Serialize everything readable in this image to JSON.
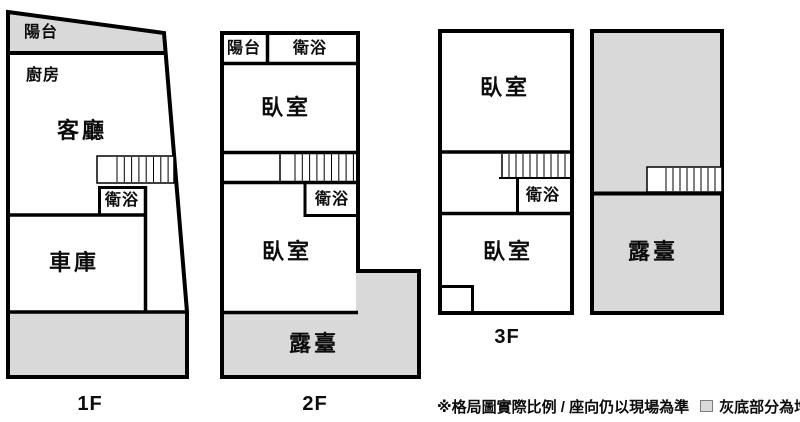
{
  "colors": {
    "addition_fill": "#d9d9d9",
    "wall": "#000000",
    "background": "#ffffff"
  },
  "icons": {
    "stairs": "stair-treads-hatch",
    "legend_swatch": "gray-filled-square"
  },
  "floors": [
    {
      "id": "1f",
      "label": "1F",
      "rooms": {
        "balcony": "陽台",
        "kitchen": "廚房",
        "living_room": "客廳",
        "bathroom": "衛浴",
        "garage": "車庫"
      }
    },
    {
      "id": "2f",
      "label": "2F",
      "rooms": {
        "balcony": "陽台",
        "bathroom_upper": "衛浴",
        "bedroom_upper": "臥室",
        "bathroom_middle": "衛浴",
        "bedroom_lower": "臥室",
        "terrace": "露臺"
      }
    },
    {
      "id": "3f",
      "label": "3F",
      "rooms": {
        "bedroom_upper": "臥室",
        "bathroom": "衛浴",
        "bedroom_lower": "臥室"
      }
    },
    {
      "id": "rooftop",
      "label": "",
      "rooms": {
        "terrace": "露臺"
      }
    }
  ],
  "footer": {
    "disclaimer": "※格局圖實際比例 / 座向仍以現場為準",
    "legend_label": "灰底部分為增建"
  }
}
